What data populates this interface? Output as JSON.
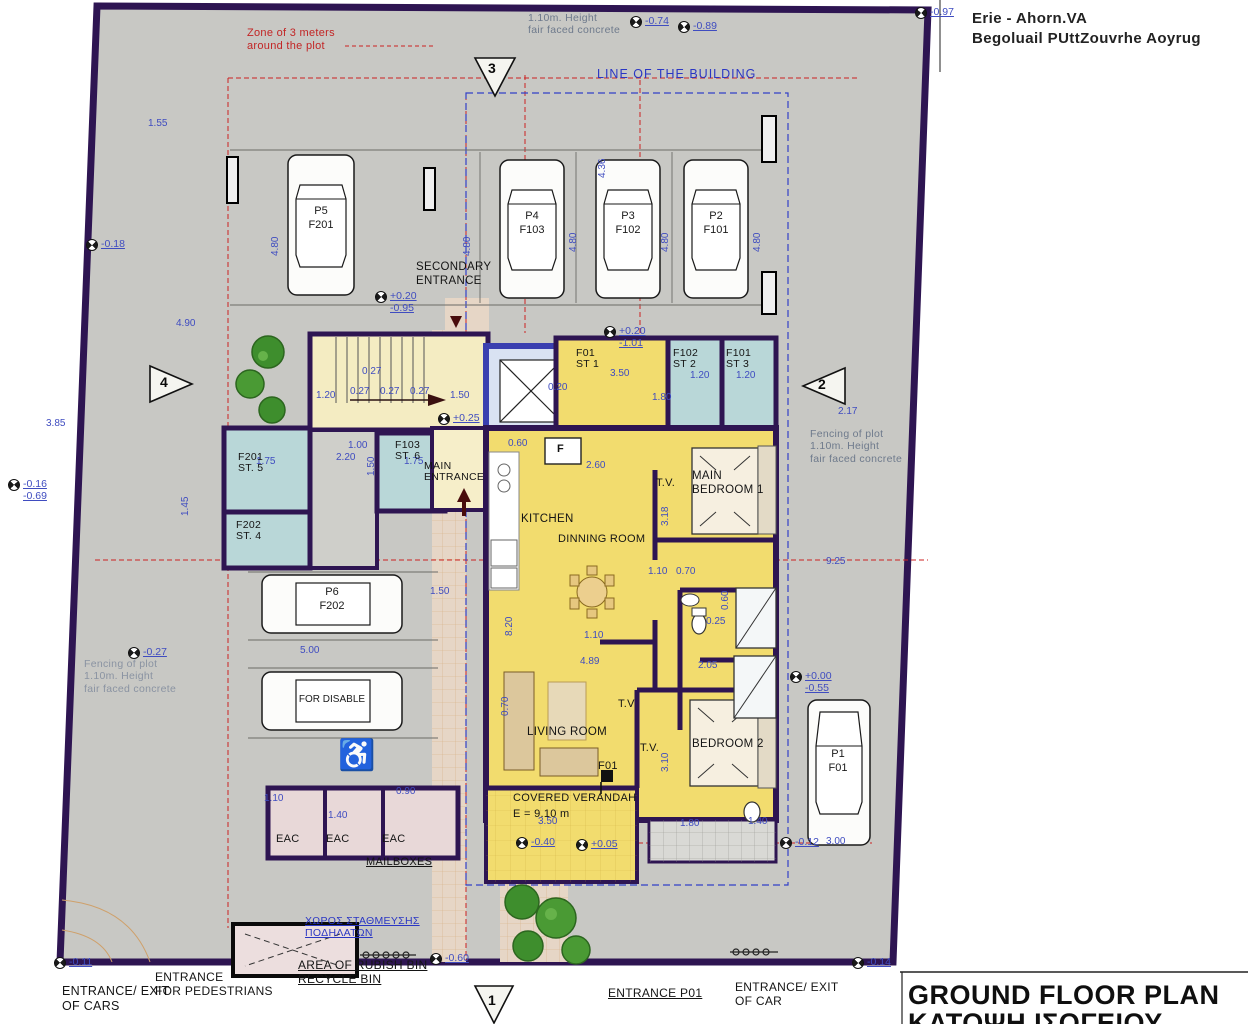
{
  "title_block": {
    "line1": "GROUND FLOOR PLAN",
    "line2": "ΚΑΤΟΨΗ ΙΣΟΓΕΙΟΥ"
  },
  "corner_text": {
    "line1": "Erie - Ahorn.VA",
    "line2": "Begoluail PUttZouvrhe Aoyrug"
  },
  "notes": {
    "zone": "Zone of 3 meters\naround the plot",
    "fence_top": "1.10m. Height\nfair faced concrete",
    "line_of_building": "LINE OF THE BUILDING",
    "fence_right": "Fencing of plot\n1.10m. Height\nfair faced concrete",
    "fence_left": "Fencing of plot\n1.10m. Height\nfair faced concrete",
    "bike_area": "ΧΩΡΟΣ ΣΤΑΘΜΕΥΣΗΣ\nΠΟΔΗΛΑΤΩΝ",
    "rubbish": "AREA OF RUBISH BIN\nRECYCLE BIN",
    "mailboxes": "MAILBOXES"
  },
  "entrances": {
    "secondary": "SECONDARY\nENTRANCE",
    "main": "MAIN\nENTRANCE",
    "exit_cars": "ENTRANCE/ EXIT\nOF CARS",
    "pedestrians": "ENTRANCE\nFOR PEDESTRIANS",
    "p01": "ENTRANCE P01",
    "exit_car": "ENTRANCE/ EXIT\nOF CAR"
  },
  "rooms": {
    "kitchen": "KITCHEN",
    "dining": "DINNING ROOM",
    "living": "LIVING ROOM",
    "main_bedroom": "MAIN\nBEDROOM 1",
    "bedroom2": "BEDROOM 2",
    "verandah": "COVERED VERANDAH",
    "verandah_area": "E = 9.10 m",
    "tv1": "T.V.",
    "tv2": "T.V",
    "tv3": "T.V.",
    "st1": "F01\nST 1",
    "st2": "F102\nST 2",
    "st3": "F101\nST 3",
    "st4": "F202\nST. 4",
    "st5": "F201\nST. 5",
    "st6": "F103\nST. 6",
    "eac1": "EAC",
    "eac2": "EAC",
    "eac3": "EAC",
    "f01": "F01"
  },
  "cars": {
    "p5": "P5\nF201",
    "p4": "P4\nF103",
    "p3": "P3\nF102",
    "p2": "P2\nF101",
    "p6": "P6\nF202",
    "disabled": "FOR DISABLE",
    "p1": "P1\nF01"
  },
  "colors": {
    "wall": "#2e1552",
    "yellow": "#f2dc6e",
    "storage_blue": "#b9d7d8",
    "plot_gray": "#c8c8c4",
    "dim_blue": "#3f4cc0",
    "note_red": "#cc2222"
  },
  "dimensions": [
    {
      "x": 148,
      "y": 118,
      "t": "1.55"
    },
    {
      "x": 597,
      "y": 178,
      "t": "4.36",
      "r": -90
    },
    {
      "x": 176,
      "y": 318,
      "t": "4.90"
    },
    {
      "x": 46,
      "y": 418,
      "t": "3.85"
    },
    {
      "x": 270,
      "y": 256,
      "t": "4.80",
      "r": -90
    },
    {
      "x": 462,
      "y": 256,
      "t": "4.80",
      "r": -90
    },
    {
      "x": 568,
      "y": 252,
      "t": "4.80",
      "r": -90
    },
    {
      "x": 660,
      "y": 252,
      "t": "4.80",
      "r": -90
    },
    {
      "x": 752,
      "y": 252,
      "t": "4.80",
      "r": -90
    },
    {
      "x": 316,
      "y": 390,
      "t": "1.20"
    },
    {
      "x": 350,
      "y": 386,
      "t": "0.27"
    },
    {
      "x": 380,
      "y": 386,
      "t": "0.27"
    },
    {
      "x": 410,
      "y": 386,
      "t": "0.27"
    },
    {
      "x": 362,
      "y": 366,
      "t": "0.27"
    },
    {
      "x": 450,
      "y": 390,
      "t": "1.50"
    },
    {
      "x": 548,
      "y": 382,
      "t": "0.20"
    },
    {
      "x": 610,
      "y": 368,
      "t": "3.50"
    },
    {
      "x": 690,
      "y": 370,
      "t": "1.20"
    },
    {
      "x": 736,
      "y": 370,
      "t": "1.20"
    },
    {
      "x": 652,
      "y": 392,
      "t": "1.80"
    },
    {
      "x": 256,
      "y": 456,
      "t": "1.75"
    },
    {
      "x": 336,
      "y": 452,
      "t": "2.20"
    },
    {
      "x": 404,
      "y": 456,
      "t": "1.75"
    },
    {
      "x": 348,
      "y": 440,
      "t": "1.00"
    },
    {
      "x": 366,
      "y": 476,
      "t": "1.50",
      "r": -90
    },
    {
      "x": 180,
      "y": 516,
      "t": "1.45",
      "r": -90
    },
    {
      "x": 508,
      "y": 438,
      "t": "0.60"
    },
    {
      "x": 586,
      "y": 460,
      "t": "2.60"
    },
    {
      "x": 838,
      "y": 406,
      "t": "2.17"
    },
    {
      "x": 648,
      "y": 566,
      "t": "1.10"
    },
    {
      "x": 676,
      "y": 566,
      "t": "0.70"
    },
    {
      "x": 504,
      "y": 636,
      "t": "8.20",
      "r": -90
    },
    {
      "x": 430,
      "y": 586,
      "t": "1.50"
    },
    {
      "x": 584,
      "y": 630,
      "t": "1.10"
    },
    {
      "x": 300,
      "y": 645,
      "t": "5.00"
    },
    {
      "x": 580,
      "y": 656,
      "t": "4.89"
    },
    {
      "x": 698,
      "y": 660,
      "t": "2.05"
    },
    {
      "x": 500,
      "y": 716,
      "t": "0.70",
      "r": -90
    },
    {
      "x": 660,
      "y": 772,
      "t": "3.10",
      "r": -90
    },
    {
      "x": 720,
      "y": 610,
      "t": "0.60",
      "r": -90
    },
    {
      "x": 706,
      "y": 616,
      "t": "0.25"
    },
    {
      "x": 826,
      "y": 556,
      "t": "9.25"
    },
    {
      "x": 660,
      "y": 526,
      "t": "3.18",
      "r": -90
    },
    {
      "x": 264,
      "y": 793,
      "t": "1.10"
    },
    {
      "x": 328,
      "y": 810,
      "t": "1.40"
    },
    {
      "x": 396,
      "y": 786,
      "t": "0.90"
    },
    {
      "x": 538,
      "y": 816,
      "t": "3.50"
    },
    {
      "x": 680,
      "y": 818,
      "t": "1.80"
    },
    {
      "x": 748,
      "y": 816,
      "t": "1.40"
    },
    {
      "x": 826,
      "y": 836,
      "t": "3.00"
    },
    {
      "x": 557,
      "y": 443,
      "t": "F",
      "c": "k"
    }
  ],
  "levels": [
    {
      "x": 630,
      "y": 15,
      "v": "-0.74"
    },
    {
      "x": 678,
      "y": 20,
      "v": "-0.89"
    },
    {
      "x": 915,
      "y": 6,
      "v": "-0.97"
    },
    {
      "x": 86,
      "y": 238,
      "v": "-0.18"
    },
    {
      "x": 375,
      "y": 290,
      "v": "+0.20\n-0.95"
    },
    {
      "x": 604,
      "y": 325,
      "v": "+0.20\n-1.01"
    },
    {
      "x": 8,
      "y": 478,
      "v": "-0.16\n-0.69"
    },
    {
      "x": 128,
      "y": 646,
      "v": "-0.27"
    },
    {
      "x": 438,
      "y": 412,
      "v": "+0.25"
    },
    {
      "x": 790,
      "y": 670,
      "v": "+0.00\n-0.55"
    },
    {
      "x": 780,
      "y": 836,
      "v": "-0.12"
    },
    {
      "x": 54,
      "y": 956,
      "v": "-0.11"
    },
    {
      "x": 852,
      "y": 956,
      "v": "-0.14"
    },
    {
      "x": 516,
      "y": 836,
      "v": "-0.40"
    },
    {
      "x": 576,
      "y": 838,
      "v": "+0.05"
    },
    {
      "x": 430,
      "y": 952,
      "v": "-0.60"
    }
  ],
  "section_markers": [
    {
      "x": 488,
      "y": 60,
      "n": "3"
    },
    {
      "x": 160,
      "y": 374,
      "n": "4"
    },
    {
      "x": 818,
      "y": 376,
      "n": "2"
    },
    {
      "x": 488,
      "y": 992,
      "n": "1"
    }
  ]
}
